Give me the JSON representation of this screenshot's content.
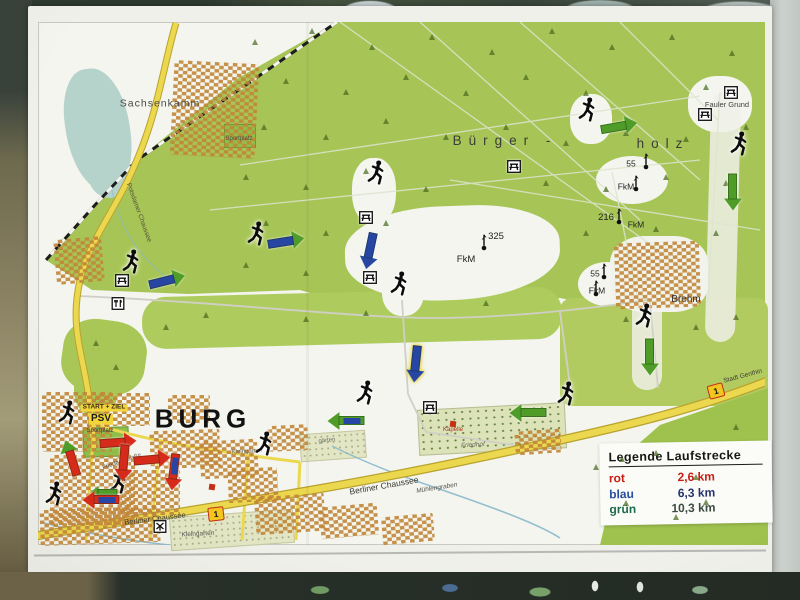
{
  "legend": {
    "title": "Legende Laufstrecke",
    "entries": [
      {
        "name": "rot",
        "color": "#c42015",
        "distance": "2,6 km",
        "value_color": "#c42015"
      },
      {
        "name": "blau",
        "color": "#2a4e9e",
        "distance": "6,3 km",
        "value_color": "#27356e"
      },
      {
        "name": "grün",
        "color": "#1d6b4f",
        "distance": "10,3 km",
        "value_color": "#3c4a42"
      }
    ]
  },
  "icon_legend": {
    "tree": "css-triangle",
    "picnic": "picnic-table svg",
    "restaurant": "fork-and-knife svg",
    "mill": "mill-cross svg",
    "mast": "radio-mast svg",
    "runner": "running-person svg"
  },
  "map": {
    "labels": [
      {
        "n": "label-sachsenkamm",
        "t": "Sachsenkamm",
        "x": 160,
        "y": 104,
        "s": 10.5,
        "c": "#4a4a46",
        "ls": 1
      },
      {
        "n": "label-buergerholz-1",
        "t": "Bürger -",
        "x": 505,
        "y": 141,
        "s": 13.5,
        "c": "#3c3c38",
        "ls": 7,
        "w": 500
      },
      {
        "n": "label-buergerholz-2",
        "t": "holz",
        "x": 663,
        "y": 144,
        "s": 13.5,
        "c": "#3c3c38",
        "ls": 7,
        "w": 500
      },
      {
        "n": "label-fauler-grund",
        "t": "Fauler Grund",
        "x": 727,
        "y": 105,
        "s": 7.5,
        "c": "#44443f"
      },
      {
        "n": "label-elev-55-1",
        "t": "55",
        "x": 631,
        "y": 164,
        "s": 8.5,
        "c": "#222222"
      },
      {
        "n": "label-fkm-1",
        "t": "FkM",
        "x": 626,
        "y": 187,
        "s": 8.5,
        "c": "#222222"
      },
      {
        "n": "label-elev-216",
        "t": "216",
        "x": 606,
        "y": 218,
        "s": 9.5,
        "c": "#222222"
      },
      {
        "n": "label-fkm-2",
        "t": "FkM",
        "x": 636,
        "y": 225,
        "s": 8.5,
        "c": "#222222"
      },
      {
        "n": "label-elev-325",
        "t": "325",
        "x": 496,
        "y": 237,
        "s": 9.5,
        "c": "#222222"
      },
      {
        "n": "label-fkm-3",
        "t": "FkM",
        "x": 466,
        "y": 260,
        "s": 9.5,
        "c": "#222222"
      },
      {
        "n": "label-elev-55-2",
        "t": "55",
        "x": 595,
        "y": 274,
        "s": 8.5,
        "c": "#222222"
      },
      {
        "n": "label-fkm-4",
        "t": "FkM",
        "x": 597,
        "y": 291,
        "s": 8.5,
        "c": "#222222"
      },
      {
        "n": "label-brehm",
        "t": "Brehm",
        "x": 686,
        "y": 300,
        "s": 10,
        "c": "#333333"
      },
      {
        "n": "label-burg",
        "t": "BURG",
        "x": 203,
        "y": 419,
        "s": 26,
        "c": "#121212",
        "w": 700,
        "ls": 5
      },
      {
        "n": "label-start-ziel",
        "t": "START + ZIEL",
        "x": 104,
        "y": 408,
        "s": 6.5,
        "c": "#3a2a10",
        "w": 700,
        "bg": "#f2d43c"
      },
      {
        "n": "label-psv",
        "t": "PSV",
        "x": 101,
        "y": 419,
        "s": 10,
        "c": "#1a1a1a",
        "w": 700,
        "bg": "#f2d43c"
      },
      {
        "n": "label-sportplatz-burg",
        "t": "Sportplatz",
        "x": 100,
        "y": 431,
        "s": 6,
        "c": "#3a3a3a"
      },
      {
        "n": "label-berliner-chaussee-1",
        "t": "Berliner Chaussee",
        "x": 384,
        "y": 486,
        "s": 8.5,
        "r": -10,
        "c": "#3a3a35"
      },
      {
        "n": "label-berliner-chaussee-2",
        "t": "Berliner Chaussee",
        "x": 155,
        "y": 519,
        "s": 7.5,
        "r": -7,
        "c": "#3a3a35"
      },
      {
        "n": "label-friedensstrasse",
        "t": "Friedensstraße",
        "x": 122,
        "y": 462,
        "s": 6,
        "r": -19,
        "c": "#4a4a44"
      },
      {
        "n": "label-kleingarten",
        "t": "Kleingarten",
        "x": 198,
        "y": 535,
        "s": 6.5,
        "r": -3,
        "c": "#55554e"
      },
      {
        "n": "label-muehlengraben",
        "t": "Mühlengraben",
        "x": 437,
        "y": 489,
        "s": 6.5,
        "r": -9,
        "c": "#55554e",
        "i": true
      },
      {
        "n": "label-stadt-genthin",
        "t": "Stadt Genthin",
        "x": 743,
        "y": 377,
        "s": 6.5,
        "r": -15,
        "c": "#3a3a35"
      },
      {
        "n": "label-kapelle",
        "t": "Kapelle",
        "x": 453,
        "y": 430,
        "s": 6,
        "c": "#a23420"
      },
      {
        "n": "label-friedhof",
        "t": "Friedhof",
        "x": 473,
        "y": 446,
        "s": 6.5,
        "c": "#6a6a60",
        "i": true,
        "r": -3
      },
      {
        "n": "label-kleingaerten",
        "t": "Kleingärten",
        "x": 247,
        "y": 452,
        "s": 6,
        "c": "#6a6a60",
        "r": -3
      },
      {
        "n": "label-gaerten",
        "t": "gärten",
        "x": 327,
        "y": 441,
        "s": 6,
        "c": "#6a6a60",
        "r": -5
      },
      {
        "n": "label-sportplatz-nord",
        "t": "Sportplatz",
        "x": 239,
        "y": 139,
        "s": 6,
        "c": "#4a4a44"
      },
      {
        "n": "label-potsdamer-chaussee",
        "t": "Potsdamer Chaussee",
        "x": 138,
        "y": 213,
        "s": 6.5,
        "r": 70,
        "c": "#55503a"
      }
    ],
    "badges": [
      {
        "t": "1",
        "x": 216,
        "y": 514,
        "r": -7
      },
      {
        "t": "1",
        "x": 716,
        "y": 391,
        "r": -15
      }
    ],
    "runners": [
      [
        132,
        266
      ],
      [
        257,
        238
      ],
      [
        377,
        177
      ],
      [
        588,
        114
      ],
      [
        400,
        288
      ],
      [
        740,
        148
      ],
      [
        645,
        320
      ],
      [
        567,
        398
      ],
      [
        366,
        397
      ],
      [
        265,
        448
      ],
      [
        68,
        417
      ],
      [
        119,
        486
      ],
      [
        55,
        498
      ]
    ],
    "arrows": [
      {
        "x": 619,
        "y": 126,
        "rot": -10,
        "body": "green"
      },
      {
        "x": 733,
        "y": 192,
        "rot": 90,
        "body": "green"
      },
      {
        "x": 650,
        "y": 357,
        "rot": 90,
        "body": "green"
      },
      {
        "x": 528,
        "y": 413,
        "rot": 180,
        "body": "green"
      },
      {
        "x": 346,
        "y": 421,
        "rot": 180,
        "body": "green",
        "overlay": "blue"
      },
      {
        "x": 167,
        "y": 280,
        "rot": -14,
        "body": "blue",
        "head": "green"
      },
      {
        "x": 286,
        "y": 241,
        "rot": -9,
        "body": "blue",
        "head": "green"
      },
      {
        "x": 370,
        "y": 251,
        "rot": 102,
        "body": "blue"
      },
      {
        "x": 416,
        "y": 364,
        "rot": 96,
        "body": "blue",
        "outline": true
      },
      {
        "x": 71,
        "y": 458,
        "rot": -107,
        "body": "red",
        "head": "green"
      },
      {
        "x": 118,
        "y": 442,
        "rot": -4,
        "body": "red"
      },
      {
        "x": 124,
        "y": 463,
        "rot": 95,
        "body": "red"
      },
      {
        "x": 152,
        "y": 459,
        "rot": -5,
        "body": "red"
      },
      {
        "x": 174,
        "y": 472,
        "rot": 97,
        "body": "red",
        "overlay": "blue"
      },
      {
        "x": 104,
        "y": 492,
        "rot": 180,
        "body": "green",
        "thin": true
      },
      {
        "x": 101,
        "y": 500,
        "rot": 180,
        "body": "red",
        "overlay": "blue"
      }
    ],
    "pois": [
      {
        "type": "picnic",
        "x": 122,
        "y": 283
      },
      {
        "type": "picnic",
        "x": 366,
        "y": 220
      },
      {
        "type": "picnic",
        "x": 370,
        "y": 280
      },
      {
        "type": "picnic",
        "x": 514,
        "y": 169
      },
      {
        "type": "picnic",
        "x": 731,
        "y": 95
      },
      {
        "type": "picnic",
        "x": 705,
        "y": 117
      },
      {
        "type": "picnic",
        "x": 430,
        "y": 410
      },
      {
        "type": "restaurant",
        "x": 118,
        "y": 306
      },
      {
        "type": "mill",
        "x": 160,
        "y": 529
      },
      {
        "type": "dot",
        "x": 453,
        "y": 424,
        "c": "#c23018"
      },
      {
        "type": "dot",
        "x": 212,
        "y": 487,
        "c": "#c23018"
      }
    ],
    "masts": [
      [
        484,
        247
      ],
      [
        646,
        166
      ],
      [
        636,
        188
      ],
      [
        619,
        221
      ],
      [
        604,
        276
      ],
      [
        596,
        293
      ]
    ],
    "building_clusters": [
      [
        172,
        62,
        85,
        95,
        3
      ],
      [
        55,
        238,
        48,
        45,
        -5
      ],
      [
        42,
        392,
        70,
        60,
        0
      ],
      [
        50,
        455,
        85,
        70,
        0
      ],
      [
        40,
        508,
        120,
        36,
        -2
      ],
      [
        120,
        470,
        60,
        45,
        0
      ],
      [
        150,
        430,
        70,
        38,
        -2
      ],
      [
        95,
        393,
        55,
        33,
        0
      ],
      [
        200,
        440,
        58,
        38,
        -3
      ],
      [
        228,
        468,
        50,
        34,
        -3
      ],
      [
        255,
        495,
        70,
        38,
        -4
      ],
      [
        320,
        505,
        58,
        32,
        -5
      ],
      [
        382,
        515,
        52,
        28,
        -5
      ],
      [
        168,
        395,
        42,
        28,
        0
      ],
      [
        615,
        242,
        85,
        66,
        -2
      ],
      [
        515,
        430,
        46,
        24,
        -4
      ],
      [
        268,
        425,
        40,
        26,
        -3
      ]
    ],
    "trees": [
      [
        255,
        45
      ],
      [
        312,
        34
      ],
      [
        372,
        50
      ],
      [
        432,
        40
      ],
      [
        492,
        55
      ],
      [
        552,
        34
      ],
      [
        612,
        50
      ],
      [
        672,
        40
      ],
      [
        732,
        56
      ],
      [
        286,
        84
      ],
      [
        346,
        95
      ],
      [
        406,
        80
      ],
      [
        466,
        96
      ],
      [
        526,
        80
      ],
      [
        586,
        96
      ],
      [
        706,
        90
      ],
      [
        264,
        130
      ],
      [
        326,
        140
      ],
      [
        386,
        124
      ],
      [
        446,
        140
      ],
      [
        506,
        130
      ],
      [
        566,
        146
      ],
      [
        626,
        136
      ],
      [
        686,
        142
      ],
      [
        746,
        130
      ],
      [
        246,
        180
      ],
      [
        306,
        190
      ],
      [
        366,
        174
      ],
      [
        426,
        192
      ],
      [
        546,
        186
      ],
      [
        606,
        192
      ],
      [
        666,
        180
      ],
      [
        726,
        186
      ],
      [
        266,
        226
      ],
      [
        326,
        236
      ],
      [
        386,
        226
      ],
      [
        586,
        236
      ],
      [
        656,
        232
      ],
      [
        716,
        236
      ],
      [
        246,
        268
      ],
      [
        306,
        276
      ],
      [
        486,
        306
      ],
      [
        366,
        316
      ],
      [
        306,
        322
      ],
      [
        206,
        318
      ],
      [
        166,
        330
      ],
      [
        96,
        346
      ],
      [
        116,
        370
      ],
      [
        626,
        322
      ],
      [
        696,
        330
      ],
      [
        736,
        320
      ],
      [
        622,
        462
      ],
      [
        656,
        456
      ],
      [
        696,
        480
      ],
      [
        736,
        430
      ],
      [
        626,
        506
      ],
      [
        676,
        520
      ],
      [
        706,
        505
      ],
      [
        596,
        470
      ]
    ]
  }
}
